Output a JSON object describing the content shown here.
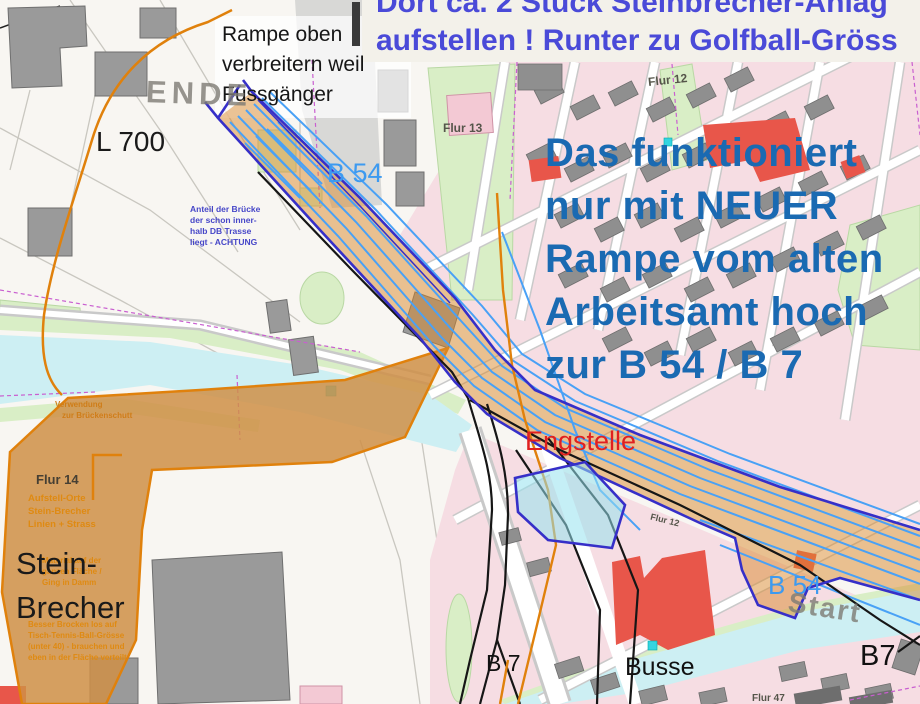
{
  "colors": {
    "note_blue": "#1a6ab2",
    "banner_blue": "#4a4ad8",
    "note_red": "#e02020",
    "route_lightblue": "#3d9af0",
    "corridor_fill": "#d98a2e",
    "corridor_border": "#362fc8",
    "area_orange": "#cf8f47",
    "orange_line": "#e0810c",
    "water_cyan": "#cdeff3",
    "map_green": "#d9eec6",
    "building_gray": "#8f8f8f",
    "building_pink": "#f6dde3",
    "building_red": "#e8564a"
  },
  "map": {
    "ende_watermark": "ENDE",
    "start_watermark": "Start",
    "l700": "L 700",
    "flur12_top": "Flur 12",
    "flur13": "Flur 13",
    "flur14": "Flur 14",
    "flur12_corridor": "Flur 12",
    "flur47": "Flur 47"
  },
  "roads": {
    "b54_top": "B 54",
    "b54_bottom": "B 54",
    "b7_south": "B 7",
    "b7_east": "B7",
    "busse": "Busse"
  },
  "notes": {
    "banner": {
      "line1": "Dort ca. 2 Stück Steinbrecher-Anlag",
      "line2": "aufstellen ! Runter zu Golfball-Gröss"
    },
    "ramp": {
      "line1": "Rampe oben",
      "line2": "verbreitern weil",
      "line3": "Fussgänger"
    },
    "main": {
      "line1": "Das funktioniert",
      "line2": "nur mit NEUER",
      "line3": "Rampe vom alten",
      "line4": "Arbeitsamt hoch",
      "line5": "zur B 54 / B 7"
    },
    "engstelle": "Engstelle",
    "steinbrecher": {
      "line1": "Stein-",
      "line2": "Brecher"
    },
    "bridge": {
      "line1": "Anteil der Brücke",
      "line2": "der schon inner-",
      "line3": "halb DB Trasse",
      "line4": "liegt - ACHTUNG"
    },
    "aufstell": {
      "line1": "Aufstell-Orte",
      "line2": "Stein-Brecher",
      "line3": "Linien + Strass"
    },
    "verwendung": {
      "line1": "Verwendung",
      "line2": "zur Brückenschutt"
    },
    "material": {
      "line1": "Material auf der",
      "line2": "ganzen Fläche /",
      "line3": "Ging in Damm"
    },
    "brocken": {
      "line1": "Besser Brocken los auf",
      "line2": "Tisch-Tennis-Ball-Grösse",
      "line3": "(unter 40) - brauchen und",
      "line4": "eben in der Fläche verteilt"
    }
  }
}
